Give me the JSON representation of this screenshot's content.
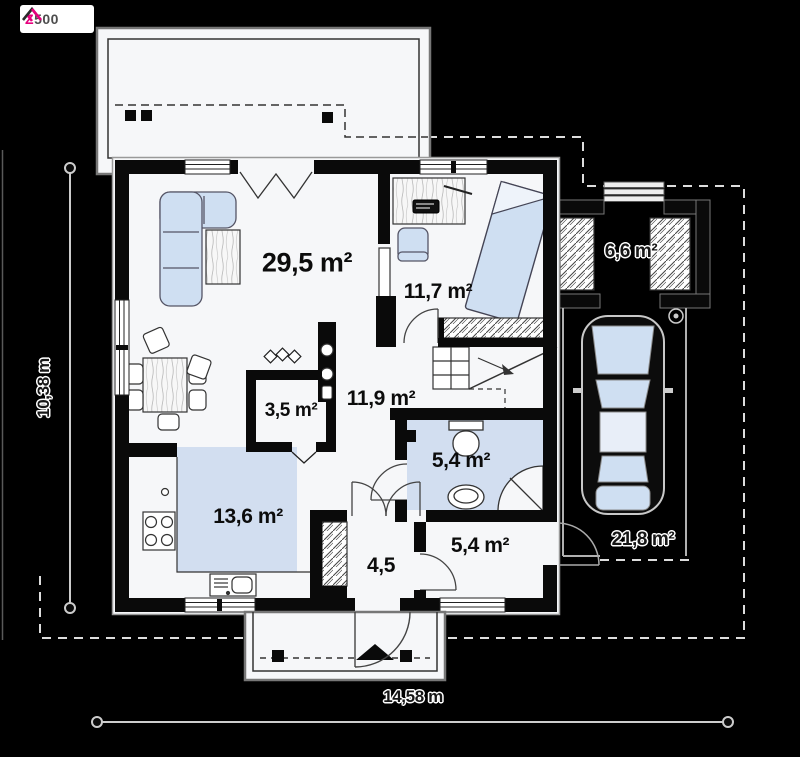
{
  "logo": {
    "brand_z": "Z",
    "brand_rest": "500"
  },
  "rooms": {
    "living": {
      "area": "29,5 m²"
    },
    "bedroom": {
      "area": "11,7 m²"
    },
    "pantry": {
      "area": "3,5 m²"
    },
    "hall": {
      "area": "11,9 m²"
    },
    "bathroom": {
      "area": "5,4 m²"
    },
    "kitchen": {
      "area": "13,6 m²"
    },
    "vestibule": {
      "area": "4,5"
    },
    "utility": {
      "area": "5,4 m²"
    },
    "storage": {
      "area": "6,6 m²"
    },
    "carport": {
      "area": "21,8 m²"
    }
  },
  "dimensions": {
    "width": "14,58 m",
    "depth": "10,38 m"
  },
  "icons": {
    "logo_roof": "roof-icon",
    "car": "car-top-view-icon",
    "entrance_marker": "entrance-triangle-icon",
    "fireplace": "fireplace-flames-icon"
  },
  "colors": {
    "background": "#000000",
    "floor": "#f6f7f9",
    "wall": "#0a0a0a",
    "furniture_fill": "#cfdff2",
    "wet_room_floor": "#d2def0",
    "brand_accent": "#e6007e",
    "roof_dash": "#dddddd"
  }
}
